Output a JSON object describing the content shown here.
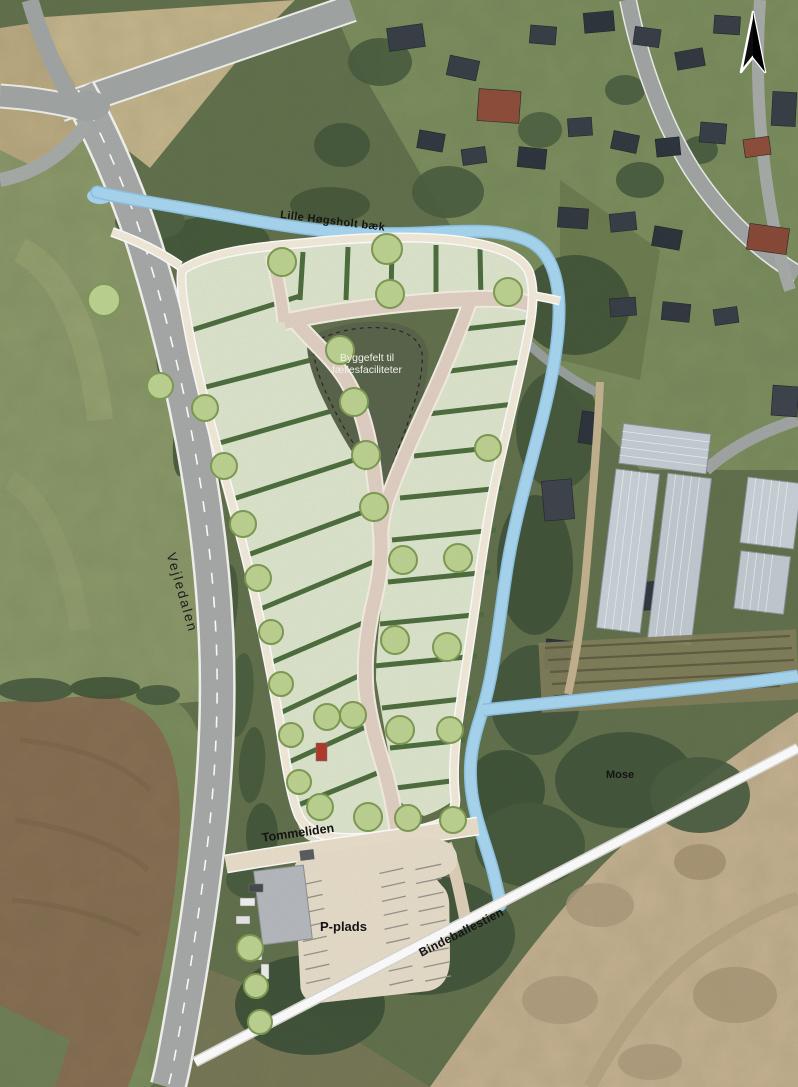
{
  "map": {
    "title": "Site development plan on aerial photo",
    "labels": {
      "stream": "Lille Høgsholt bæk",
      "byggefelt_line1": "Byggefelt til",
      "byggefelt_line2": "fællesfaciliteter",
      "road_main": "Vejledalen",
      "road_access": "Tommeliden",
      "parking": "P-plads",
      "path_south": "Bindeballestien",
      "bog": "Mose"
    },
    "north_arrow": "north",
    "colors": {
      "stream_blue": "#a9d7f1",
      "lot_green": "#dee5cd",
      "hedge_green": "#4f6f3f",
      "tree_green": "#bdd392",
      "loop_path_cream": "#f3ebda",
      "inner_road_beige": "#e1d1c4",
      "byggefelt_olive": "#5a654c",
      "parking_beige": "#e7ddca",
      "sand_tan": "#c8b493",
      "field_brown": "#8a7054",
      "field_tan": "#c9b98f",
      "asphalt_gray": "#a7aaa8",
      "white_path": "#ffffff"
    }
  }
}
